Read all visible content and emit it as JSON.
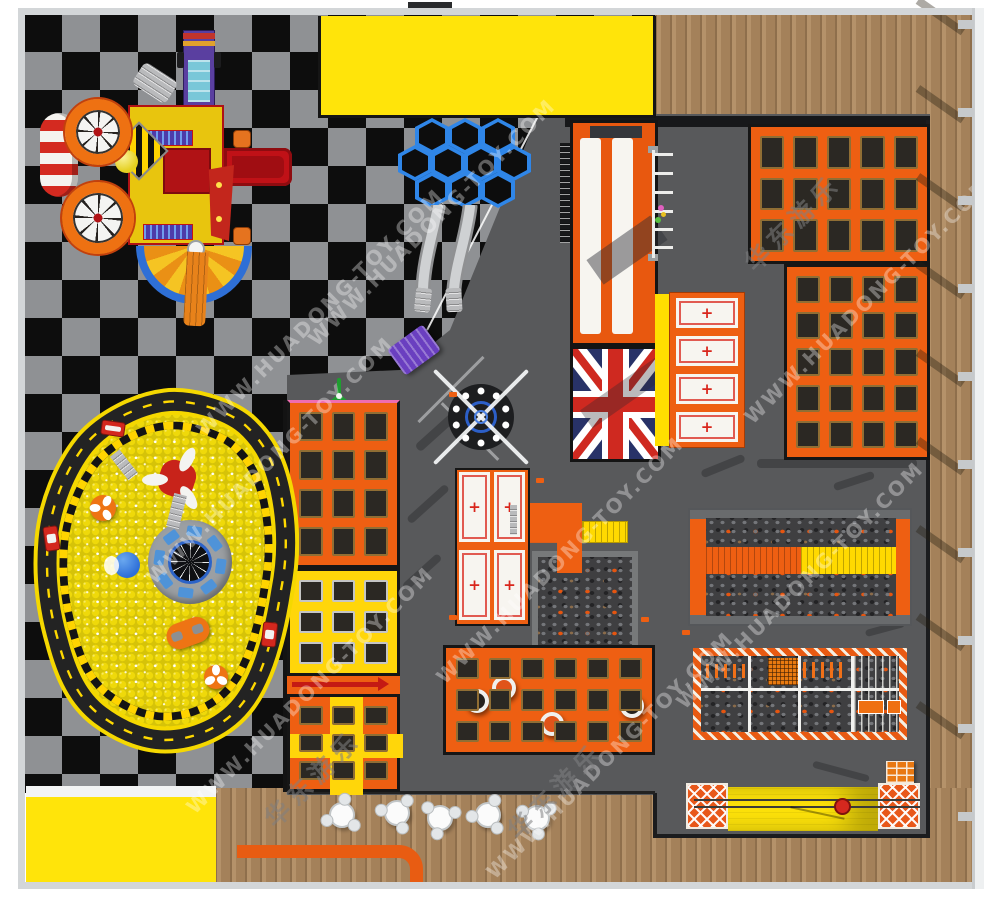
{
  "watermark": {
    "url_text": "WWW.HUADONG-TOY.COM",
    "cn_text": "华东游乐"
  },
  "palette": {
    "orange": "#ee5f12",
    "yellow": "#ffdf00",
    "yellow_room": "#ffe40a",
    "floor_gray": "#58595b",
    "wood": "#b08b61",
    "check_dark": "#0d0d0d",
    "check_light": "#8f9194",
    "mat_dark": "#2b2823",
    "track_black": "#232323",
    "ball_yellow": "#efd90a",
    "flag_navy": "#283268",
    "flag_red": "#cf2920",
    "blue": "#2f86e8",
    "red": "#d02a1e",
    "white_mat": "#f7f5f0",
    "hazard_yellow": "#ffd400"
  }
}
